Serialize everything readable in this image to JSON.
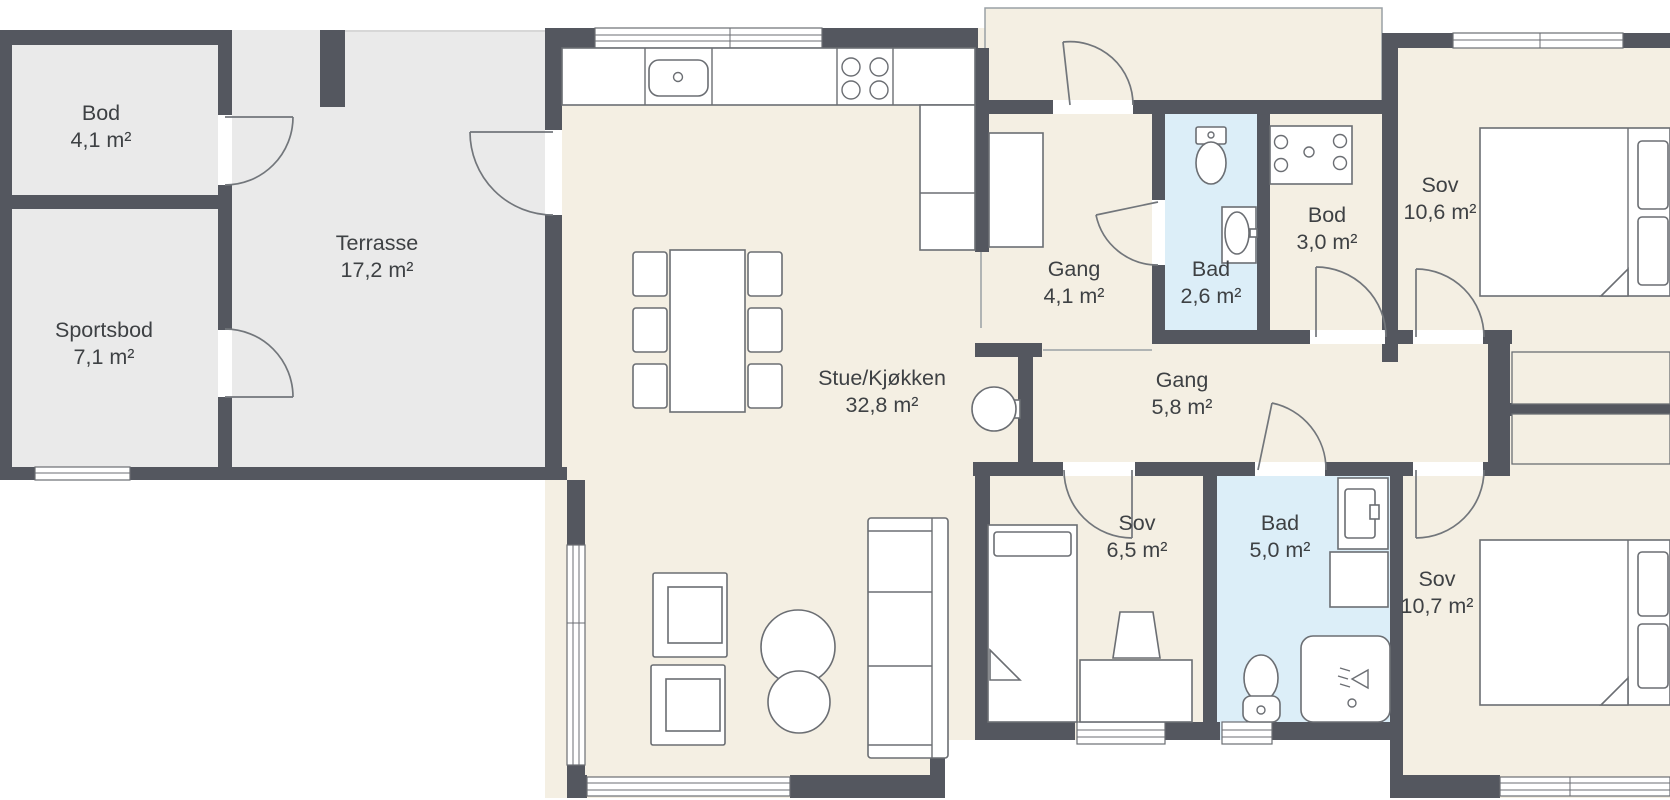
{
  "floorplan": {
    "type": "residential-floor-plan",
    "rooms": [
      {
        "id": "bod-41",
        "name": "Bod",
        "area": "4,1 m²"
      },
      {
        "id": "sportsbod",
        "name": "Sportsbod",
        "area": "7,1 m²"
      },
      {
        "id": "terrasse",
        "name": "Terrasse",
        "area": "17,2 m²"
      },
      {
        "id": "stue",
        "name": "Stue/Kjøkken",
        "area": "32,8 m²"
      },
      {
        "id": "gang-41",
        "name": "Gang",
        "area": "4,1 m²"
      },
      {
        "id": "bad-26",
        "name": "Bad",
        "area": "2,6 m²"
      },
      {
        "id": "bod-30",
        "name": "Bod",
        "area": "3,0 m²"
      },
      {
        "id": "sov-106",
        "name": "Sov",
        "area": "10,6 m²"
      },
      {
        "id": "gang-58",
        "name": "Gang",
        "area": "5,8 m²"
      },
      {
        "id": "sov-65",
        "name": "Sov",
        "area": "6,5 m²"
      },
      {
        "id": "bad-50",
        "name": "Bad",
        "area": "5,0 m²"
      },
      {
        "id": "sov-107",
        "name": "Sov",
        "area": "10,7 m²"
      }
    ],
    "colors": {
      "wall": "#54575f",
      "floor_main": "#f4efe3",
      "floor_outdoor": "#eaeaea",
      "floor_bath": "#dceef8",
      "outline": "#6b6e73",
      "door": "#72767b",
      "thin": "#9aa0a5",
      "label": "#3e4144"
    },
    "furniture_icons": [
      "kitchen-counter",
      "kitchen-sink",
      "stove-burners",
      "dining-table",
      "dining-chair",
      "wood-stove",
      "armchair",
      "coffee-table",
      "sofa",
      "double-bed",
      "single-bed",
      "pillow",
      "blanket-fold",
      "desk",
      "desk-chair",
      "toilet",
      "bathroom-sink",
      "laundry-machine",
      "washer-cabinet",
      "shower",
      "wardrobe",
      "hall-closet"
    ]
  }
}
